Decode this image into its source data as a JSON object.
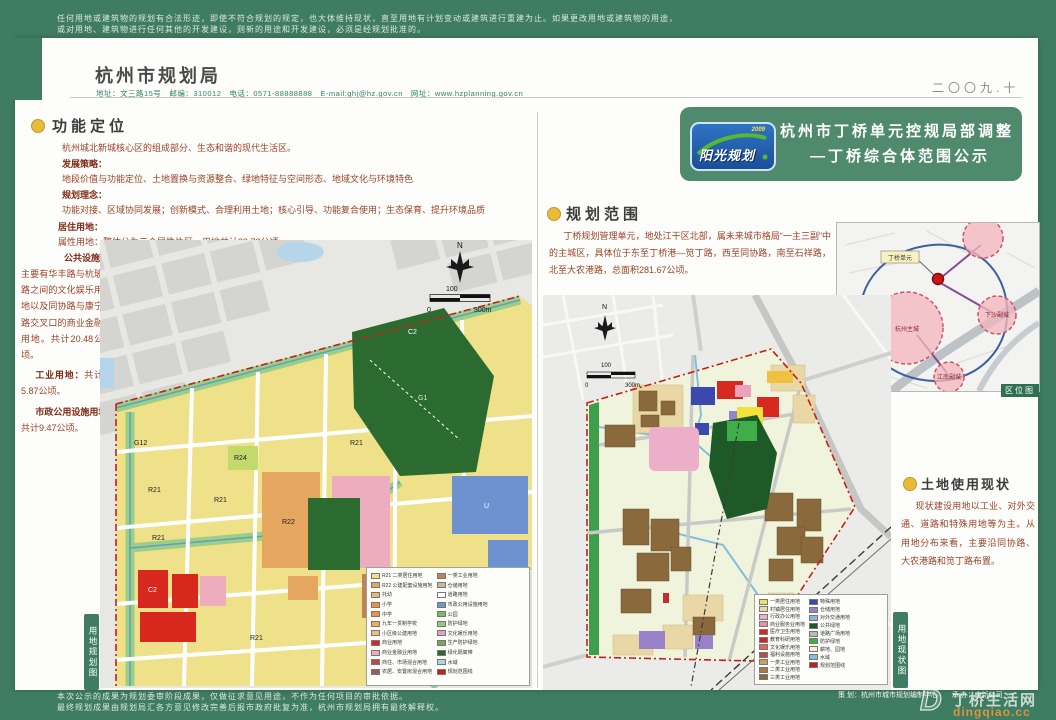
{
  "colors": {
    "page_green": "#3f7d62",
    "banner_green": "#4e8a6b",
    "bullet_yellow": "#e9bb3a",
    "text_maroon": "#9c4226",
    "boundary_red": "#c42018",
    "park_green": "#2c6b2f"
  },
  "top_bar": {
    "line1": "任何用地或建筑物的规划有合法形迹，即使不符合规划的规定，也大体维持现状，直至用地有计划变动或建筑进行重建为止。如果更改用地或建筑物的用途，",
    "line2": "或对用地、建筑物进行任何其他的开发建设，则新的用途和开发建设，必须是经规划批准的。"
  },
  "header": {
    "bureau": "杭州市规划局",
    "contact": "地址：文三路15号　邮编：310012　电话：0571-88888888　E-mail:ghj@hz.gov.cn　网址：www.hzplanning.gov.cn",
    "date": "二〇〇九.十"
  },
  "banner": {
    "logo_name": "阳光规划",
    "logo_year": "2009",
    "title1": "杭州市丁桥单元控规局部调整",
    "title2": "—丁桥综合体范围公示"
  },
  "left_panel": {
    "title": "功能定位",
    "intro": "杭州城北新城核心区的组成部分、生态和谐的现代生活区。",
    "strategy_label": "发展策略：",
    "strategy": "地段价值与功能定位、土地置换与资源整合、绿地特征与空间形态、地域文化与环境特色",
    "concept_label": "规划理念：",
    "concept": "功能对接、区域协同发展；创新模式、合理利用土地；核心引导、功能复合使用；生态保育、提升环境品质",
    "residential_label": "居住用地：",
    "residential": "属性用地：整体分为三个属性片区，用地共计89.73公顷。",
    "public_label": "公共设施用地：",
    "public_text": "主要有华丰路与杭玻路之间的文化娱乐用地以及同协路与康宁路交叉口的商业金融用地。共计20.48公顷。",
    "industry_label": "工业用地：",
    "industry_text": "共计5.87公顷。",
    "municipal_label": "市政公用设施用地：",
    "municipal_text": "共计9.47公顷。",
    "map_tab": "用地规划图"
  },
  "left_map": {
    "north": "N",
    "scale0": "0",
    "scale100": "100",
    "scale300": "300m",
    "codes": [
      "R21",
      "R21",
      "R21",
      "R21",
      "R21",
      "R22",
      "C2",
      "C2",
      "R24",
      "G12",
      "U",
      "G1"
    ],
    "legend_col1": [
      {
        "c": "#efe08a",
        "t": "R21 二类居住用地"
      },
      {
        "c": "#e5a75f",
        "t": "R22 公建配套设施用地"
      },
      {
        "c": "#e8b870",
        "t": "托幼"
      },
      {
        "c": "#f09048",
        "t": "小学"
      },
      {
        "c": "#f09048",
        "t": "中学"
      },
      {
        "c": "#f4a860",
        "t": "九年一贯制学校"
      },
      {
        "c": "#e8c080",
        "t": "小区级公建用地"
      },
      {
        "c": "#d8271d",
        "t": "商业用地"
      },
      {
        "c": "#eeadbe",
        "t": "商业金融业用地"
      },
      {
        "c": "#c04848",
        "t": "商住、市场混合用地"
      },
      {
        "c": "#a05858",
        "t": "农居、安置房混合用地"
      }
    ],
    "legend_col2": [
      {
        "c": "#bd8456",
        "t": "一类工业用地"
      },
      {
        "c": "#c8b898",
        "t": "仓储用地"
      },
      {
        "c": "#ffffff",
        "t": "道路用地"
      },
      {
        "c": "#6d92cf",
        "t": "市政公用设施用地"
      },
      {
        "c": "#80b860",
        "t": "公园"
      },
      {
        "c": "#98c878",
        "t": "防护绿地"
      },
      {
        "c": "#e8a0b8",
        "t": "文化娱乐用地"
      },
      {
        "c": "#78a850",
        "t": "生产防护绿地"
      },
      {
        "c": "#2c6b2f",
        "t": "绿化隔离带"
      },
      {
        "c": "#aed4e8",
        "t": "水域"
      },
      {
        "c": "#c42018",
        "t": "规划范围线"
      }
    ]
  },
  "right_panel": {
    "scope_title": "规划范围",
    "scope_text": "丁桥规划管理单元，地处江干区北部，属未来城市格局“一主三副”中的主城区，具体位于东至丁桥港—笕丁路，西至同协路，南至石祥路，北至大农港路，总面积281.67公顷。",
    "status_title": "土地使用现状",
    "status_text": "现状建设用地以工业、对外交通、道路和特殊用地等为主。从用地分布来看，主要沿同协路、大农港路和笕丁路布置。",
    "map_tab": "用地现状图",
    "locator_label": "区位图",
    "locator": {
      "unit": "丁桥单元",
      "main": "杭州主城",
      "xiasha": "下沙副城",
      "jiangnan": "江南副城"
    }
  },
  "right_map": {
    "north": "N",
    "scale0": "0",
    "scale100": "100",
    "scale300": "300m",
    "legend_col1": [
      {
        "c": "#f0e060",
        "t": "一类居住用地"
      },
      {
        "c": "#e9d8a6",
        "t": "村镇居住用地"
      },
      {
        "c": "#f0b0c8",
        "t": "行政办公用地"
      },
      {
        "c": "#e890a8",
        "t": "商业服务业用地"
      },
      {
        "c": "#d62a20",
        "t": "医疗卫生用地"
      },
      {
        "c": "#c82820",
        "t": "教育科研用地"
      },
      {
        "c": "#e06858",
        "t": "文化娱乐用地"
      },
      {
        "c": "#b85048",
        "t": "福利设施用地"
      },
      {
        "c": "#c8a060",
        "t": "一类工业用地"
      },
      {
        "c": "#a87840",
        "t": "二类工业用地"
      },
      {
        "c": "#8a6a3c",
        "t": "三类工业用地"
      }
    ],
    "legend_col2": [
      {
        "c": "#3a49ae",
        "t": "特殊用地"
      },
      {
        "c": "#9781c9",
        "t": "仓储用地"
      },
      {
        "c": "#88b8d8",
        "t": "对外交通用地"
      },
      {
        "c": "#1d5a28",
        "t": "公共绿地"
      },
      {
        "c": "#b8b8b8",
        "t": "道路广场用地"
      },
      {
        "c": "#3fae48",
        "t": "防护绿地"
      },
      {
        "c": "#f4f0d0",
        "t": "耕地、园地"
      },
      {
        "c": "#85bedd",
        "t": "水域"
      },
      {
        "c": "#c42018",
        "t": "规划范围线"
      }
    ]
  },
  "footer": {
    "line1": "本次公示的成果为规划委审阶段成果，仅做征求意见用途，不作为任何项目的审批依据。",
    "line2": "最终规划成果由规划局汇各方意见修改完善后报市政府批复为准，杭州市规划局拥有最终解释权。",
    "credit1": "策 划：杭州市城市规划编制中心",
    "credit2": "承 办：中新公司",
    "watermark_letter": "D",
    "watermark_name": "丁桥生活网",
    "watermark_domain": "dingqiao.cc"
  }
}
